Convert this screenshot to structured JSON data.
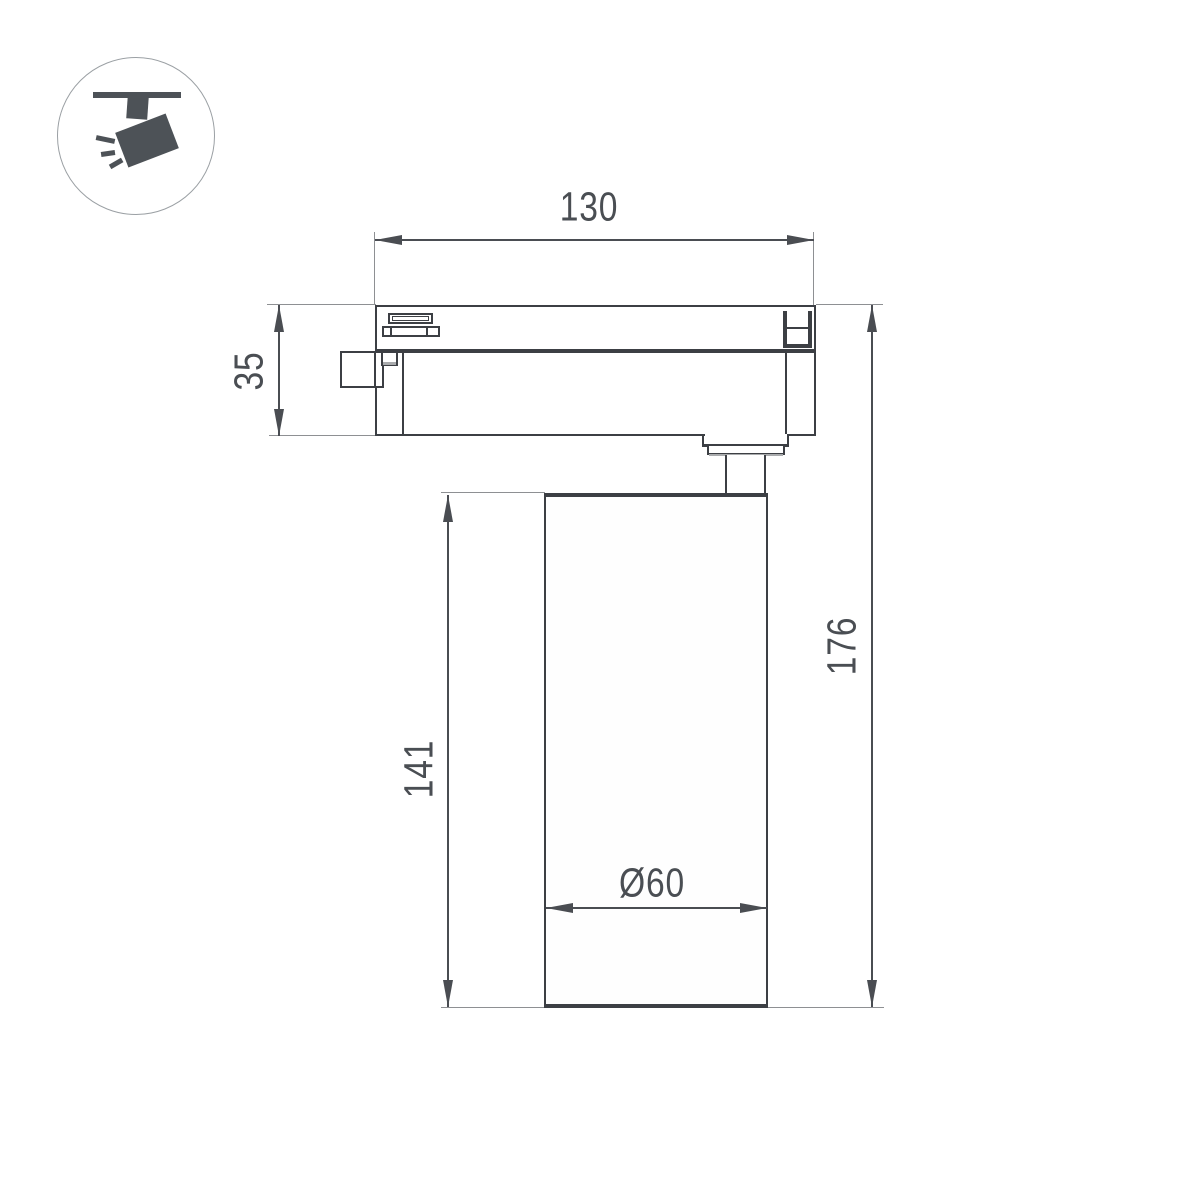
{
  "icon": {
    "name": "track-spotlight",
    "color": "#4d5257",
    "circle_stroke": "#9ba0a4"
  },
  "drawing": {
    "line_color": "#3c3f44",
    "dimension_color": "#4a4d52",
    "extension_color": "#8e9093",
    "background": "#ffffff",
    "dimensions": {
      "adapter_width": "130",
      "adapter_height": "35",
      "body_height": "141",
      "total_height": "176",
      "diameter": "Ø60"
    }
  }
}
